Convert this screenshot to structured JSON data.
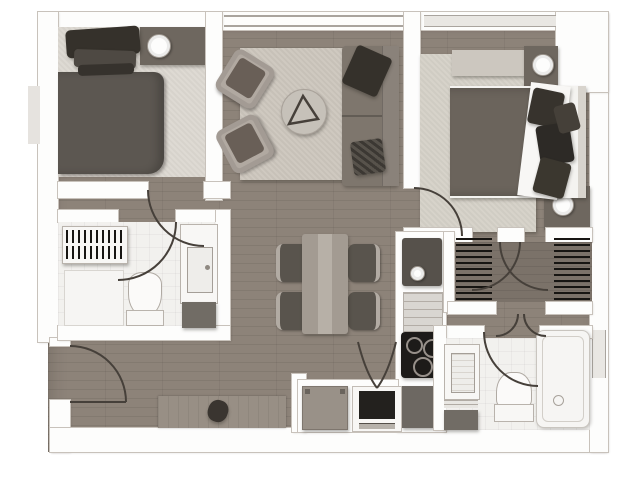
{
  "title": "apartment floor plan (top-down architectural drawing, no text labels)",
  "legend": {
    "bedroom_1": "bedroom 1",
    "living_room": "living room",
    "bedroom_2": "bedroom 2",
    "bathroom_1": "bathroom 1",
    "dining_area": "dining area",
    "kitchen": "kitchen",
    "walk_in_closet": "walk-in closet",
    "bathroom_2": "bathroom 2",
    "laundry_nook": "laundry nook",
    "entry_hall": "entry hall"
  },
  "inventory": {
    "bedroom_1": [
      "double-bed",
      "pillows",
      "bedside-console",
      "table-lamp",
      "carpet"
    ],
    "living_room": [
      "rug",
      "armchair",
      "armchair",
      "round-coffee-table",
      "triangle-decor",
      "sofa",
      "dark-cushion",
      "checkered-cushion"
    ],
    "bedroom_2": [
      "rug",
      "dresser",
      "double-bed",
      "duvet",
      "folded-sheet",
      "pillows",
      "headboard",
      "nightstand",
      "table-lamp",
      "nightstand",
      "table-lamp"
    ],
    "bathroom_1": [
      "wardrobe-rails",
      "vanity-sink",
      "toilet",
      "shower",
      "dark-mat"
    ],
    "dining_area": [
      "dining-table",
      "chair",
      "chair",
      "chair",
      "chair"
    ],
    "kitchen": [
      "sink",
      "faucet",
      "dishwasher",
      "cooktop-3-burners",
      "base-cabinet"
    ],
    "walk_in_closet": [
      "hanging-rail-left",
      "hanging-rail-right",
      "double-swing-doors"
    ],
    "bathroom_2": [
      "vanity-sink",
      "shelf",
      "dark-mat",
      "toilet",
      "bathtub",
      "window"
    ],
    "laundry_nook": [
      "washing-machine",
      "oven",
      "bifold-doors"
    ],
    "entry_hall": [
      "entry-door",
      "doormat",
      "decor-object"
    ]
  },
  "windows": [
    "living-room-window-top",
    "bedroom-2-window-top",
    "bathroom-2-window-right"
  ],
  "doors": [
    "entry-door",
    "bedroom-1-door",
    "bathroom-1-door",
    "bedroom-2-door",
    "closet-door-left",
    "closet-door-right",
    "closet-lower-doors",
    "bathroom-2-door",
    "laundry-bifold-doors"
  ],
  "palette": {
    "wood": "#8d8379",
    "wood_dark": "#7b7269",
    "wall": "#fdfdfc",
    "wall_edge": "#c8c2bb",
    "tile": "#f2f1ee",
    "carpet": "#dedad3",
    "rug_living": "#cfc9c0",
    "rug_bedroom2": "#d7d3ca",
    "linen": "#f8f7f5",
    "duvet1": "#5c5751",
    "duvet2": "#6b645c",
    "pillow_dark": "#35312b",
    "bed_base": "#f4f3f0",
    "headboard": "#d8d4cd",
    "sofa": "#7e766d",
    "sofa_back": "#8a827a",
    "armchair": "#b1a9a1",
    "armchair_seat": "#695f57",
    "coffee_table": "#c6c1b9",
    "table": "#a39b92",
    "table_runner": "#b7b0a7",
    "chair": "#59544d",
    "chair_back": "#b2aba3",
    "console": "#6e675f",
    "dresser": "#ccc7bf",
    "sink_dark": "#56514b",
    "steel": "#d9d6d1",
    "charcoal": "#1d1b19",
    "appliance": "#6d6862",
    "washer": "#999188",
    "tray": "#716c65",
    "mat": "#988f85",
    "window": "#e9e7e3",
    "arc": "#46403a"
  }
}
